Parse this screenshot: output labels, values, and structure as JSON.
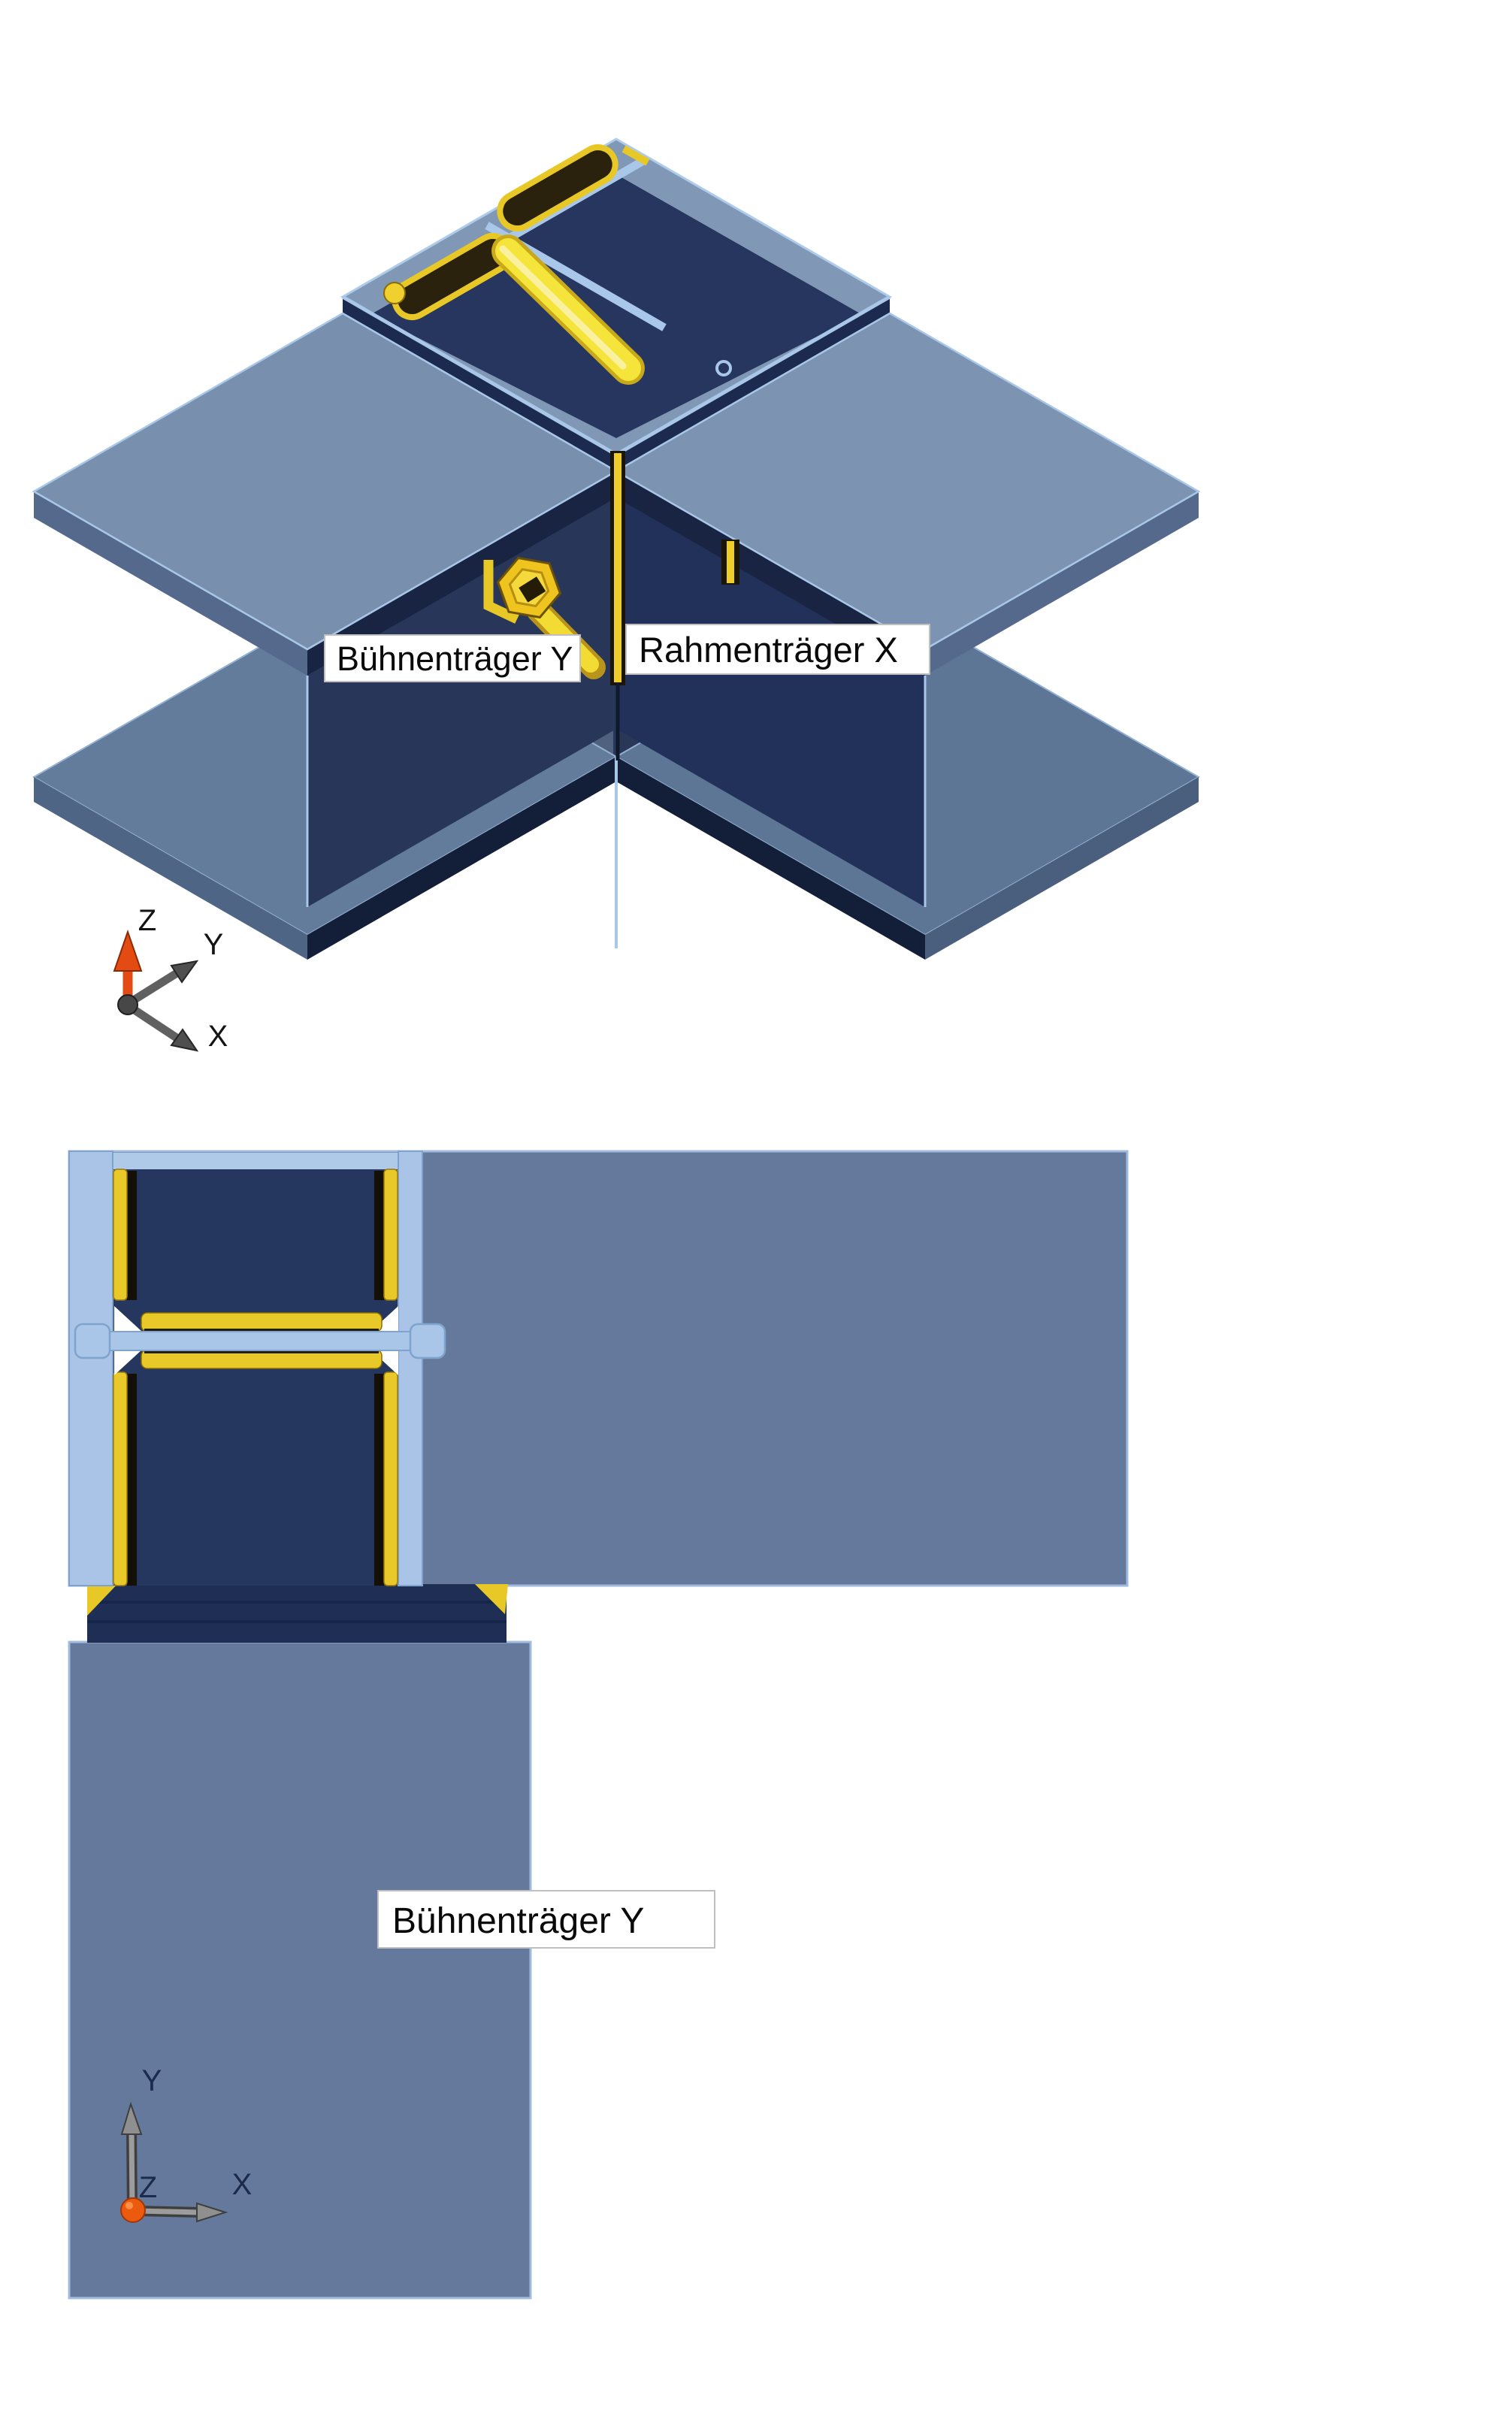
{
  "iso_view": {
    "title": "3D view of beam-to-beam corner connection",
    "labels": {
      "beam_y": "Bühnenträger Y",
      "beam_x": "Rahmenträger X"
    },
    "axes": {
      "z": "Z",
      "y": "Y",
      "x": "X"
    }
  },
  "plan_view": {
    "title": "Plan view of connection",
    "labels": {
      "beam_y": "Bühnenträger Y"
    },
    "axes": {
      "y": "Y",
      "z": "Z",
      "x": "X"
    }
  },
  "colors": {
    "steel_blue": "#64799B",
    "steel_blue_light": "#7C93B1",
    "steel_blue_deck": "#8098B6",
    "navy_web": "#26375F",
    "navy_dark": "#1B2A4E",
    "edge_highlight": "#A9C7E8",
    "weld_yellow": "#E9C829",
    "rod_yellow": "#F5E43A",
    "axis_red": "#E34B12",
    "axis_gray": "#8F8F8F",
    "label_text": "#0A0A0A",
    "label_background": "#FFFFFF"
  }
}
